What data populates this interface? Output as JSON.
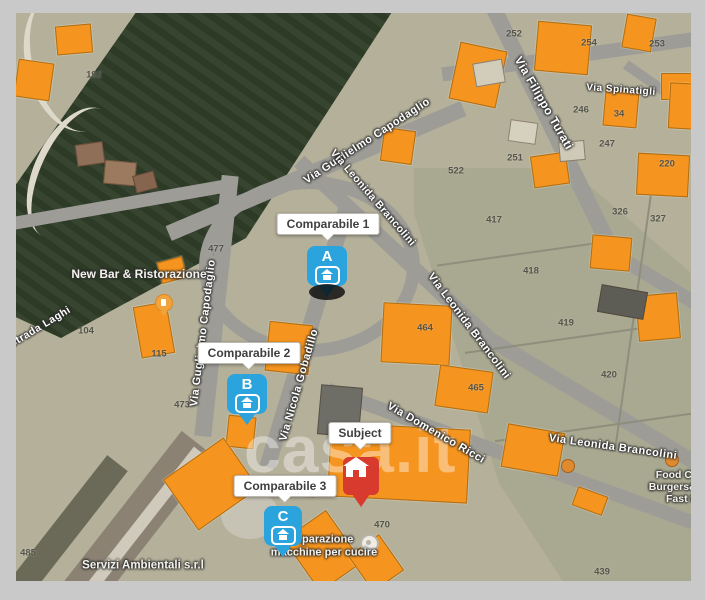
{
  "map": {
    "watermark": "casa.it",
    "markers": [
      {
        "id": "comparable-1",
        "letter": "A",
        "label": "Comparabile 1",
        "color": "#2BA3DC"
      },
      {
        "id": "comparable-2",
        "letter": "B",
        "label": "Comparabile 2",
        "color": "#2BA3DC"
      },
      {
        "id": "comparable-3",
        "letter": "C",
        "label": "Comparabile 3",
        "color": "#2BA3DC"
      },
      {
        "id": "subject",
        "letter": "",
        "label": "Subject",
        "color": "#D93A2E"
      }
    ],
    "street_labels": [
      {
        "text": "Via Guglielmo Capodaglio",
        "x": 351,
        "y": 128,
        "rot": -33,
        "size": 11
      },
      {
        "text": "Via Guglielmo Capodaglio",
        "x": 187,
        "y": 320,
        "rot": -83,
        "size": 11
      },
      {
        "text": "Via Leonida Brancolini",
        "x": 357,
        "y": 185,
        "rot": 49,
        "size": 10.5
      },
      {
        "text": "Via Leonida Brancolini",
        "x": 453,
        "y": 313,
        "rot": 53,
        "size": 11
      },
      {
        "text": "Via Leonida Brancolini",
        "x": 597,
        "y": 434,
        "rot": 8,
        "size": 11
      },
      {
        "text": "Via Filippo Turati",
        "x": 528,
        "y": 90,
        "rot": 60,
        "size": 12
      },
      {
        "text": "Via Nicola Gobadillo",
        "x": 283,
        "y": 372,
        "rot": -74,
        "size": 11
      },
      {
        "text": "Via Domenico Ricci",
        "x": 420,
        "y": 420,
        "rot": 30,
        "size": 11
      },
      {
        "text": "Via Spinatigli",
        "x": 605,
        "y": 77,
        "rot": 4,
        "size": 10
      },
      {
        "text": "Strada Laghi",
        "x": 24,
        "y": 314,
        "rot": -31,
        "size": 10.5
      }
    ],
    "parcel_numbers": [
      {
        "v": "192",
        "x": 78,
        "y": 62
      },
      {
        "v": "104",
        "x": 70,
        "y": 318
      },
      {
        "v": "115",
        "x": 143,
        "y": 341
      },
      {
        "v": "477",
        "x": 200,
        "y": 236
      },
      {
        "v": "473",
        "x": 166,
        "y": 392
      },
      {
        "v": "485",
        "x": 12,
        "y": 540
      },
      {
        "v": "522",
        "x": 440,
        "y": 158
      },
      {
        "v": "417",
        "x": 478,
        "y": 207
      },
      {
        "v": "418",
        "x": 515,
        "y": 258
      },
      {
        "v": "419",
        "x": 550,
        "y": 310
      },
      {
        "v": "420",
        "x": 593,
        "y": 362
      },
      {
        "v": "464",
        "x": 409,
        "y": 315
      },
      {
        "v": "465",
        "x": 460,
        "y": 375
      },
      {
        "v": "470",
        "x": 366,
        "y": 512
      },
      {
        "v": "439",
        "x": 586,
        "y": 559
      },
      {
        "v": "254",
        "x": 573,
        "y": 30
      },
      {
        "v": "253",
        "x": 641,
        "y": 31
      },
      {
        "v": "252",
        "x": 498,
        "y": 21
      },
      {
        "v": "251",
        "x": 499,
        "y": 145
      },
      {
        "v": "247",
        "x": 591,
        "y": 131
      },
      {
        "v": "246",
        "x": 565,
        "y": 97
      },
      {
        "v": "220",
        "x": 651,
        "y": 151
      },
      {
        "v": "34",
        "x": 603,
        "y": 101
      },
      {
        "v": "326",
        "x": 604,
        "y": 199
      },
      {
        "v": "327",
        "x": 642,
        "y": 206
      }
    ],
    "place_labels": [
      {
        "lines": [
          "New Bar & Ristorazione"
        ],
        "x": 123,
        "y": 262,
        "size": 12
      },
      {
        "lines": [
          "riparazione",
          "macchine per cucire"
        ],
        "x": 308,
        "y": 533,
        "size": 11
      },
      {
        "lines": [
          "Servizi Ambientali s.r.l",
          ""
        ],
        "x": 127,
        "y": 553,
        "size": 11.5
      },
      {
        "lines": [
          "Food Cha",
          "Burgers&Dri",
          "Fast f"
        ],
        "x": 664,
        "y": 474,
        "size": 10.5
      }
    ],
    "pois": [
      {
        "name": "restaurant-poi"
      },
      {
        "name": "generic-poi"
      }
    ],
    "colors": {
      "comparable_marker": "#2BA3DC",
      "subject_marker": "#D93A2E",
      "building_overlay": "#F5941F",
      "road": "#9D9C97",
      "field": "#B4B09A",
      "parcel_field": "#A9A891",
      "forest": "#2E3B27",
      "frame": "#C9C9C9"
    }
  }
}
